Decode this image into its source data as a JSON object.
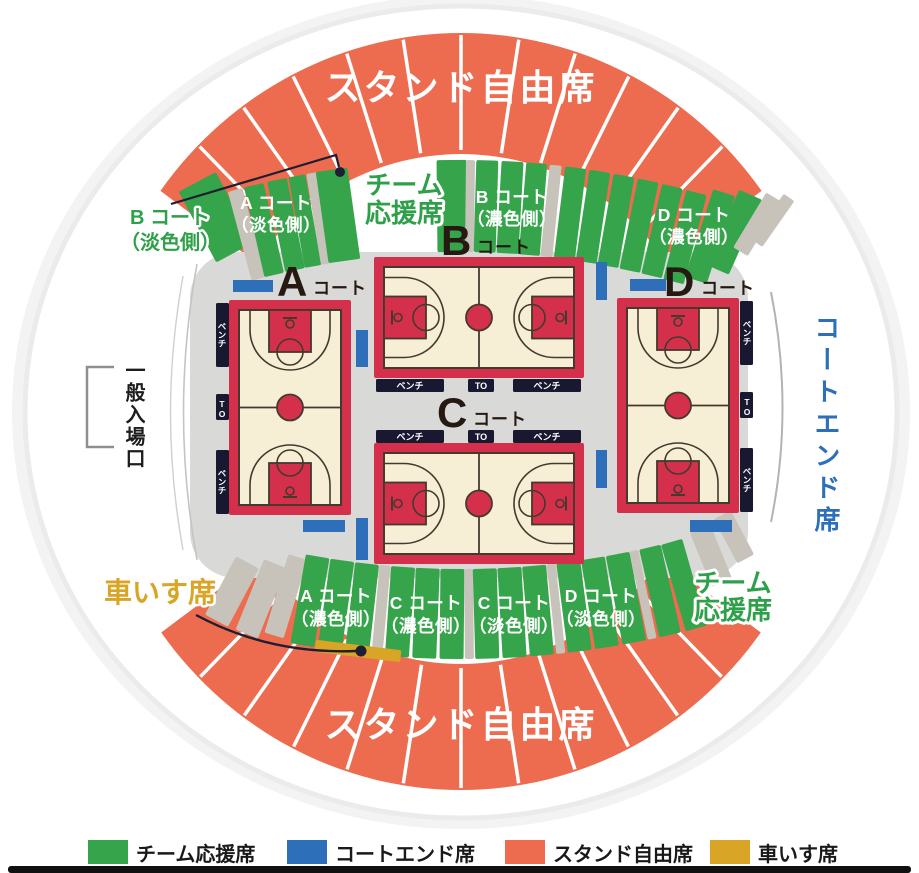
{
  "colors": {
    "orange": "#ED6C4F",
    "green": "#35A44B",
    "gray_wedge": "#C8C3BA",
    "blue": "#2D6FB8",
    "gold": "#D8A527",
    "infield": "#D9D9D7",
    "court_red": "#D4304B",
    "court_floor": "#F6EED5",
    "court_line": "#45392E",
    "bench_dark": "#181830",
    "label_dark": "#251912",
    "text_green": "#2FA04A",
    "pointer": "#1E1E33"
  },
  "stands": {
    "top": "スタンド自由席",
    "bottom": "スタンド自由席"
  },
  "outer_labels": {
    "b_court_pale": {
      "line1": "B コート",
      "line2": "（淡色側）"
    },
    "entrance": "一般入場口",
    "court_end": "コートエンド席",
    "wheelchair": "車いす席",
    "team_top": {
      "line1": "チーム",
      "line2": "応援席"
    },
    "team_bottom": {
      "line1": "チーム",
      "line2": "応援席"
    }
  },
  "top_sections": [
    {
      "line1": "A コート",
      "line2": "（淡色側）"
    },
    {
      "line1": "B コート",
      "line2": "（濃色側）"
    },
    {
      "line1": "D コート",
      "line2": "（濃色側）"
    }
  ],
  "bottom_sections": [
    {
      "line1": "A コート",
      "line2": "（濃色側）"
    },
    {
      "line1": "C コート",
      "line2": "（濃色側）"
    },
    {
      "line1": "C コート",
      "line2": "（淡色側）"
    },
    {
      "line1": "D コート",
      "line2": "（淡色側）"
    }
  ],
  "courts": {
    "a": {
      "letter": "A",
      "suffix": "コート"
    },
    "b": {
      "letter": "B",
      "suffix": "コート"
    },
    "c": {
      "letter": "C",
      "suffix": "コート"
    },
    "d": {
      "letter": "D",
      "suffix": "コート"
    }
  },
  "bench_label": "ベンチ",
  "to_label": "TO",
  "legend": [
    {
      "label": "チーム応援席",
      "color": "#35A44B"
    },
    {
      "label": "コートエンド席",
      "color": "#2D6FB8"
    },
    {
      "label": "スタンド自由席",
      "color": "#ED6C4F"
    },
    {
      "label": "車いす席",
      "color": "#D8A527"
    }
  ]
}
